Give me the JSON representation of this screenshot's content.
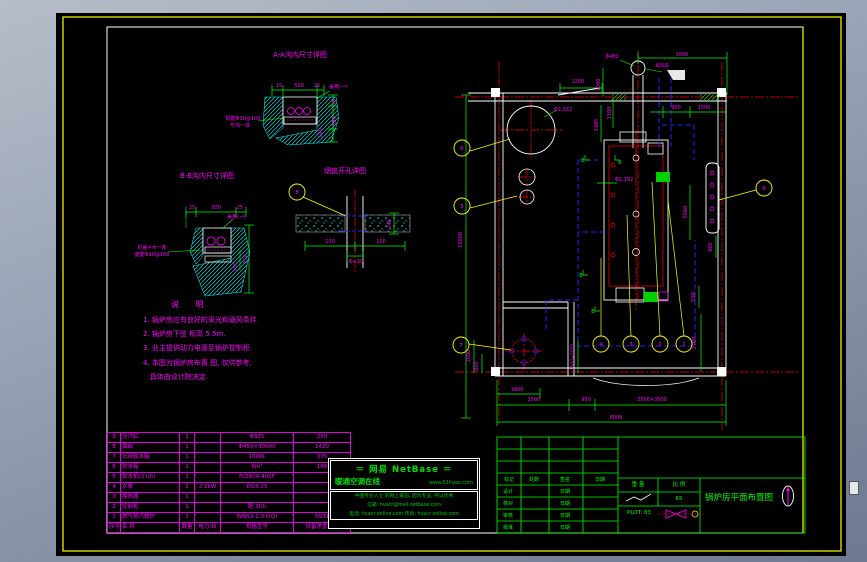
{
  "sheet_title": "锅炉房平面布置图",
  "svg_labels": [
    {
      "t": "A-A沟内尺寸详图",
      "x": 300,
      "y": 57,
      "s": 7
    },
    {
      "t": "15",
      "x": 279,
      "y": 87,
      "s": 5
    },
    {
      "t": "500",
      "x": 299,
      "y": 87,
      "s": 5
    },
    {
      "t": "25",
      "x": 317,
      "y": 87,
      "s": 5
    },
    {
      "t": "盖板(→)",
      "x": 338,
      "y": 88,
      "s": 5
    },
    {
      "t": "钢筋Φ10@100",
      "x": 243,
      "y": 120,
      "s": 5
    },
    {
      "t": "与沟一体",
      "x": 240,
      "y": 127,
      "s": 5
    },
    {
      "t": "20",
      "x": 336,
      "y": 102,
      "r": -90,
      "s": 5
    },
    {
      "t": "550",
      "x": 336,
      "y": 121,
      "r": -90,
      "s": 5
    },
    {
      "t": "100",
      "x": 322,
      "y": 133,
      "r": -90,
      "s": 5
    },
    {
      "t": "B-B沟内尺寸详图",
      "x": 207,
      "y": 178,
      "s": 7
    },
    {
      "t": "25",
      "x": 192,
      "y": 209,
      "s": 5
    },
    {
      "t": "300",
      "x": 216,
      "y": 209,
      "s": 5
    },
    {
      "t": "25",
      "x": 240,
      "y": 209,
      "s": 5
    },
    {
      "t": "盖板(→)",
      "x": 236,
      "y": 218,
      "s": 5
    },
    {
      "t": "封盖=木一条",
      "x": 152,
      "y": 249,
      "s": 5
    },
    {
      "t": "面筋Φ10@100",
      "x": 152,
      "y": 256,
      "s": 5
    },
    {
      "t": "550",
      "x": 247,
      "y": 259,
      "r": -90,
      "s": 5
    },
    {
      "t": "150",
      "x": 237,
      "y": 267,
      "r": -90,
      "s": 5
    },
    {
      "t": "烟囱开孔详图",
      "x": 345,
      "y": 173,
      "s": 7
    },
    {
      "t": "100",
      "x": 330,
      "y": 243,
      "s": 5
    },
    {
      "t": "100",
      "x": 381,
      "y": 243,
      "s": 5
    },
    {
      "t": "Φ+30",
      "x": 356,
      "y": 263,
      "s": 5
    },
    {
      "t": "240",
      "x": 391,
      "y": 224,
      "r": -90,
      "s": 5
    },
    {
      "t": "Φ480",
      "x": 612,
      "y": 58,
      "s": 5
    },
    {
      "t": "3000",
      "x": 682,
      "y": 56,
      "s": 5
    },
    {
      "t": "排风扇",
      "x": 662,
      "y": 67,
      "s": 4.5
    },
    {
      "t": "1200",
      "x": 578,
      "y": 83,
      "s": 5
    },
    {
      "t": "1000",
      "x": 600,
      "y": 85,
      "r": -90,
      "s": 5
    },
    {
      "t": "1100",
      "x": 611,
      "y": 113,
      "r": -90,
      "s": 5
    },
    {
      "t": "1385",
      "x": 598,
      "y": 125,
      "r": -90,
      "s": 5
    },
    {
      "t": "900",
      "x": 676,
      "y": 109,
      "s": 5
    },
    {
      "t": "1500",
      "x": 704,
      "y": 109,
      "s": 5
    },
    {
      "t": "Φ2,032",
      "x": 563,
      "y": 111,
      "s": 5
    },
    {
      "t": "Φ2,192",
      "x": 624,
      "y": 181,
      "s": 5
    },
    {
      "t": "10000",
      "x": 462,
      "y": 240,
      "r": -90,
      "s": 5
    },
    {
      "t": "5060",
      "x": 687,
      "y": 212,
      "r": -90,
      "s": 5
    },
    {
      "t": "800",
      "x": 712,
      "y": 247,
      "r": -90,
      "s": 5
    },
    {
      "t": "500",
      "x": 695,
      "y": 297,
      "r": -90,
      "s": 5
    },
    {
      "t": "2700",
      "x": 696,
      "y": 343,
      "r": -90,
      "s": 5
    },
    {
      "t": "2500",
      "x": 470,
      "y": 356,
      "r": -90,
      "s": 5
    },
    {
      "t": "800",
      "x": 478,
      "y": 366,
      "r": -90,
      "s": 5
    },
    {
      "t": "1500×2050",
      "x": 574,
      "y": 357,
      "r": -90,
      "s": 4.5
    },
    {
      "t": "1000",
      "x": 517,
      "y": 391,
      "s": 5
    },
    {
      "t": "2500",
      "x": 534,
      "y": 401,
      "s": 5
    },
    {
      "t": "900",
      "x": 586,
      "y": 401,
      "s": 5
    },
    {
      "t": "3500×3500",
      "x": 652,
      "y": 401,
      "s": 5
    },
    {
      "t": "8000",
      "x": 616,
      "y": 419,
      "s": 5
    },
    {
      "t": "B",
      "x": 583,
      "y": 162,
      "c": "g",
      "s": 5
    },
    {
      "t": "B",
      "x": 620,
      "y": 164,
      "c": "g",
      "s": 5
    },
    {
      "t": "B",
      "x": 581,
      "y": 277,
      "c": "g",
      "s": 5
    },
    {
      "t": "B",
      "x": 593,
      "y": 313,
      "c": "g",
      "s": 5
    },
    {
      "t": "标记",
      "x": 509,
      "y": 481,
      "c": "g",
      "s": 5
    },
    {
      "t": "处数",
      "x": 534,
      "y": 481,
      "c": "g",
      "s": 5
    },
    {
      "t": "签名",
      "x": 565,
      "y": 481,
      "c": "g",
      "s": 5
    },
    {
      "t": "日期",
      "x": 600,
      "y": 481,
      "c": "g",
      "s": 5
    },
    {
      "t": "设计",
      "x": 508,
      "y": 493,
      "c": "g",
      "s": 5
    },
    {
      "t": "日期",
      "x": 565,
      "y": 493,
      "c": "g",
      "s": 5
    },
    {
      "t": "校对",
      "x": 508,
      "y": 505,
      "c": "g",
      "s": 5
    },
    {
      "t": "日期",
      "x": 565,
      "y": 505,
      "c": "g",
      "s": 5
    },
    {
      "t": "审核",
      "x": 508,
      "y": 517,
      "c": "g",
      "s": 5
    },
    {
      "t": "日期",
      "x": 565,
      "y": 517,
      "c": "g",
      "s": 5
    },
    {
      "t": "批准",
      "x": 508,
      "y": 529,
      "c": "g",
      "s": 5
    },
    {
      "t": "日期",
      "x": 565,
      "y": 529,
      "c": "g",
      "s": 5
    },
    {
      "t": "重 量",
      "x": 638,
      "y": 486,
      "c": "g",
      "s": 5.5
    },
    {
      "t": "比 例",
      "x": 679,
      "y": 486,
      "c": "g",
      "s": 5.5
    },
    {
      "t": "65",
      "x": 679,
      "y": 500,
      "c": "g",
      "s": 5.5
    },
    {
      "t": "PLOT: 83",
      "x": 639,
      "y": 514,
      "c": "g",
      "s": 5.5
    },
    {
      "t": "锅炉房平面布置图",
      "x": 739,
      "y": 500,
      "c": "g",
      "s": 8.5
    }
  ],
  "balloons": [
    {
      "n": "8",
      "x": 297,
      "y": 192
    },
    {
      "n": "6",
      "x": 462,
      "y": 148
    },
    {
      "n": "5",
      "x": 462,
      "y": 206
    },
    {
      "n": "7",
      "x": 461,
      "y": 345
    },
    {
      "n": "9",
      "x": 764,
      "y": 188
    },
    {
      "n": "4",
      "x": 601,
      "y": 344
    },
    {
      "n": "3",
      "x": 631,
      "y": 344
    },
    {
      "n": "2",
      "x": 660,
      "y": 344
    },
    {
      "n": "1",
      "x": 684,
      "y": 344
    }
  ],
  "notes": {
    "title": "说  明",
    "lines": [
      "1. 锅炉房应有良好的采光和通风条件",
      "2. 锅炉房下弦 标高 5.5m.",
      "3. 业主提供动力电源至锅炉控制柜.",
      "4. 本图为锅炉房布置 图, 仅供参考,",
      "   具体由设计院决定."
    ]
  },
  "bom": {
    "headers": [
      "序号",
      "名  称",
      "数量",
      "电力/台",
      "规格型号",
      "设备净重(kg)"
    ],
    "rows": [
      [
        "9",
        "分汽缸",
        "1",
        "",
        "Φ325",
        "250"
      ],
      [
        "8",
        "烟囱",
        "1",
        "",
        "Φ450×30000",
        "1420"
      ],
      [
        "7",
        "日用软水箱",
        "1",
        "",
        "1000L",
        "335"
      ],
      [
        "6",
        "软水箱",
        "1",
        "",
        "8m³",
        "188"
      ],
      [
        "5",
        "软水机(3 t/h)",
        "1",
        "",
        "FL5800-400F",
        ""
      ],
      [
        "4",
        "水泵",
        "2",
        "2.2kW",
        "DG3-25",
        ""
      ],
      [
        "3",
        "换热器",
        "1",
        "",
        "",
        ""
      ],
      [
        "2",
        "控制柜",
        "1",
        "",
        "配 3t/h",
        ""
      ],
      [
        "1",
        "燃气蒸汽锅炉",
        "1",
        "",
        "WNS3-1.0-Y(Q)",
        "5931"
      ]
    ]
  },
  "watermark": {
    "brand": "＝  网易  NetBase  ＝",
    "site": "暖通空调在线",
    "url": "www.51hvac.com",
    "tagline": "中国专业人士 的网上家园, 因为专业, 所以优秀",
    "mail": "信箱: hvacr@mail.netbase.com",
    "phone": "电话: hvacr-online.com  传真: hvacr-online.com"
  },
  "titleblock": {
    "scale_value": "65",
    "plot": "PLOT: 83",
    "drawing_title": "锅炉房平面布置图"
  },
  "colors": {
    "magenta": "#FF00FF",
    "green": "#00FF00",
    "cyan": "#00FFFF",
    "yellow": "#FFFF00",
    "red": "#FF0000",
    "blue": "#2222FF",
    "white": "#FFFFFF"
  }
}
